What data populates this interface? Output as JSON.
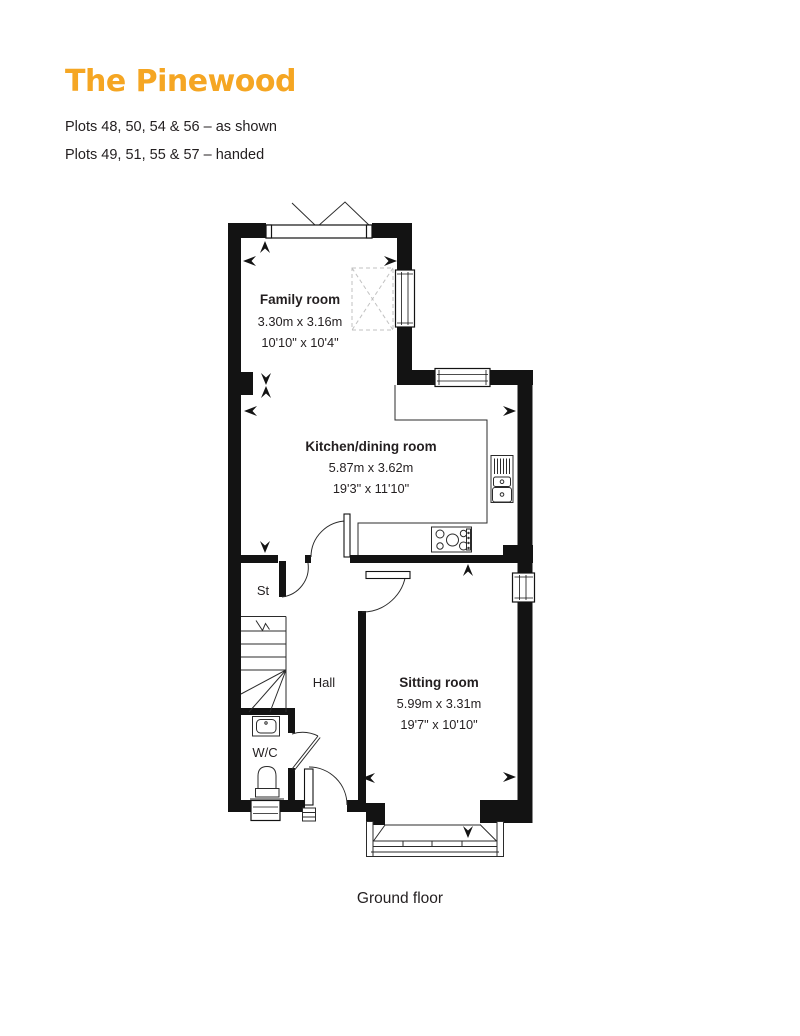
{
  "header": {
    "title": "The Pinewood",
    "plots_line1": "Plots 48, 50, 54 & 56 – as shown",
    "plots_line2": "Plots 49, 51, 55 & 57 – handed"
  },
  "floorplan": {
    "caption": "Ground floor",
    "rooms": [
      {
        "name": "Family room",
        "metric": "3.30m x 3.16m",
        "imperial": "10'10\" x 10'4\""
      },
      {
        "name": "Kitchen/dining room",
        "metric": "5.87m x 3.62m",
        "imperial": "19'3\" x 11'10\""
      },
      {
        "name": "Sitting room",
        "metric": "5.99m x 3.31m",
        "imperial": "19'7\" x 10'10\""
      }
    ],
    "small_rooms": {
      "store": "St",
      "hall": "Hall",
      "wc": "W/C"
    }
  },
  "colors": {
    "accent": "#F5A623",
    "wall": "#131313",
    "text": "#231F20"
  }
}
